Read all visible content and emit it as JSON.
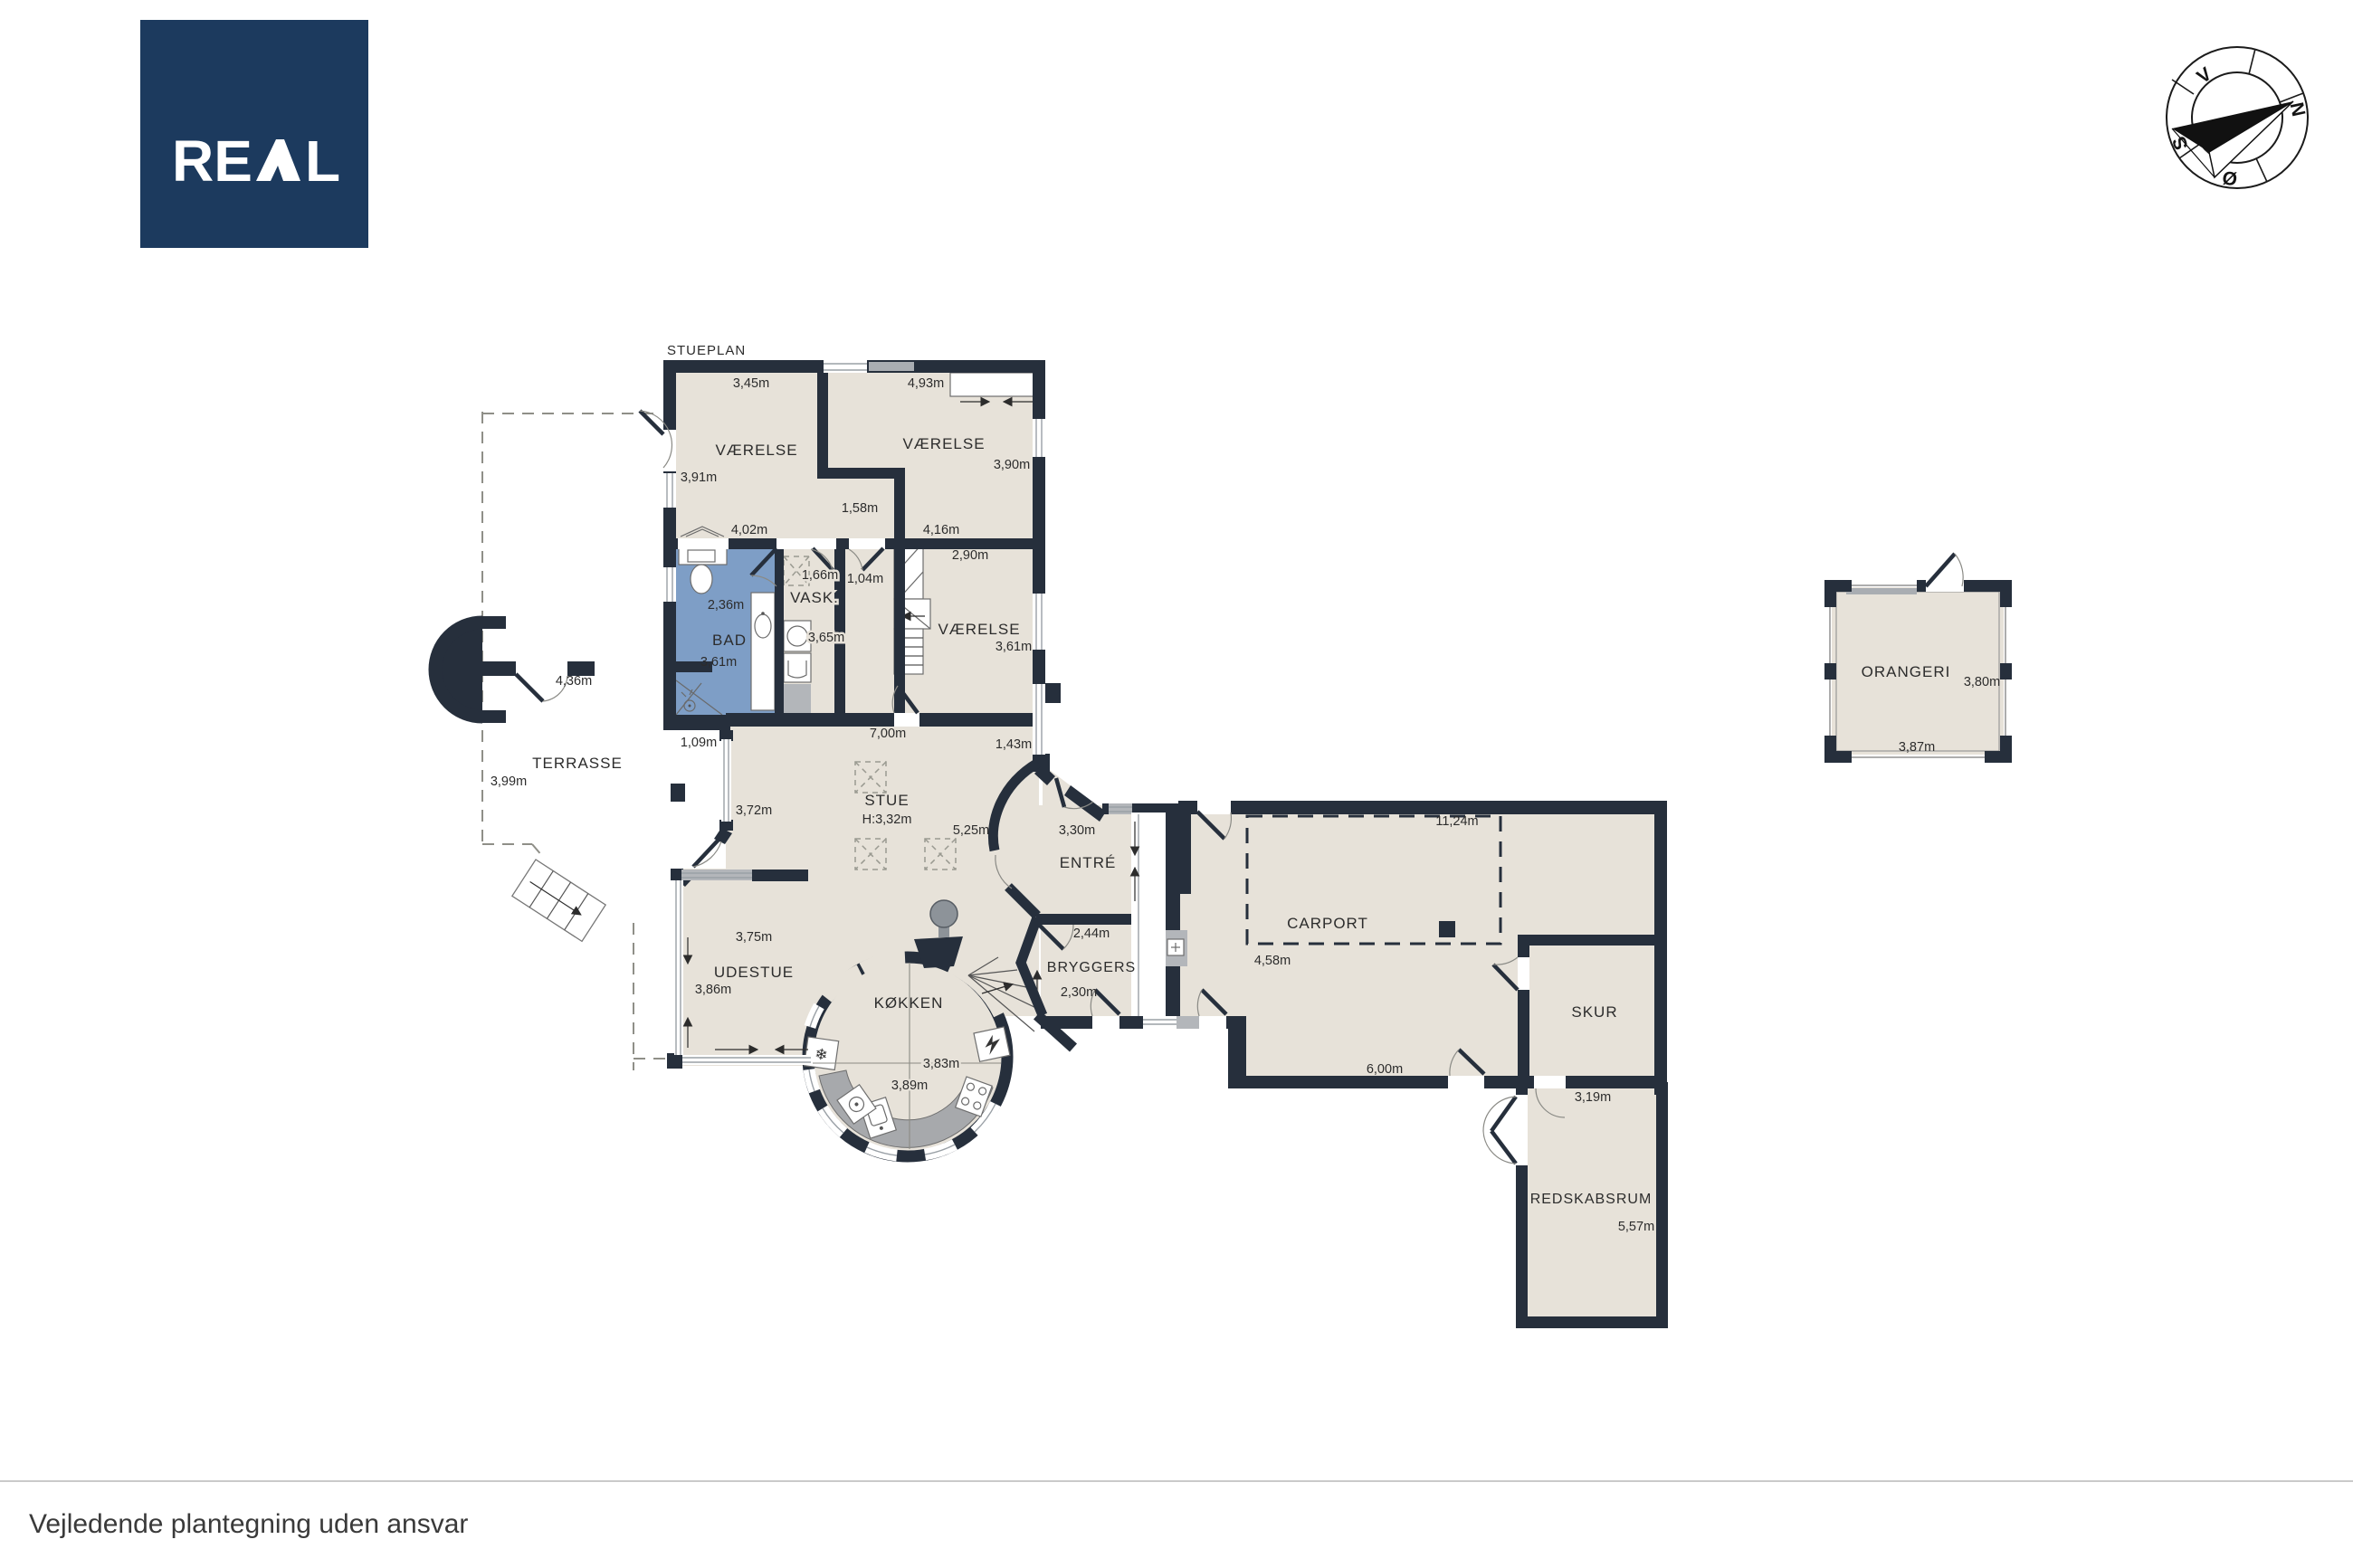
{
  "plan": {
    "title": "STUEPLAN"
  },
  "footer": {
    "disclaimer": "Vejledende plantegning uden ansvar"
  },
  "logo": {
    "text": "REAL",
    "part_re": "RE",
    "part_l": "L",
    "bg_color": "#1c3a5e"
  },
  "compass": {
    "north": "N",
    "south": "S",
    "east": "Ø",
    "west": "V"
  },
  "colors": {
    "wall": "#262f3c",
    "floor": "#e7e2d9",
    "bath": "#7e9ec6",
    "counter": "#a7a9ac"
  },
  "rooms": {
    "vaerelse_nw": {
      "label": "VÆRELSE",
      "width": "3,45m",
      "depth": "3,91m",
      "wall": "4,02m"
    },
    "vaerelse_ne": {
      "label": "VÆRELSE",
      "width": "4,93m",
      "depth": "3,90m"
    },
    "corridor": {
      "width": "1,58m",
      "door_a": "1,66m",
      "door_b": "1,04m"
    },
    "bad": {
      "label": "BAD",
      "width": "2,36m",
      "depth": "3,61m"
    },
    "vask": {
      "label": "VASK.",
      "depth": "3,65m"
    },
    "vaerelse_mid": {
      "label": "VÆRELSE",
      "width": "2,90m",
      "depth": "3,61m",
      "wall": "4,16m"
    },
    "stue": {
      "label": "STUE",
      "ceiling": "H:3,32m",
      "width": "7,00m",
      "depth": "5,25m",
      "side": "3,72m",
      "niche": "1,09m",
      "window": "1,43m"
    },
    "entre": {
      "label": "ENTRÉ",
      "width": "3,30m"
    },
    "bryggers": {
      "label": "BRYGGERS",
      "width": "2,44m",
      "depth": "2,30m"
    },
    "udestue": {
      "label": "UDESTUE",
      "width": "3,75m",
      "depth": "3,86m"
    },
    "kokken": {
      "label": "KØKKEN",
      "width": "3,83m",
      "depth": "3,89m"
    },
    "terrasse": {
      "label": "TERRASSE",
      "depth": "3,99m",
      "gap": "4,36m"
    },
    "carport": {
      "label": "CARPORT",
      "width": "4,58m",
      "length": "11,24m",
      "south": "6,00m"
    },
    "skur": {
      "label": "SKUR"
    },
    "redskabsrum": {
      "label": "REDSKABSRUM",
      "width": "3,19m",
      "depth": "5,57m"
    },
    "orangeri": {
      "label": "ORANGERI",
      "width": "3,87m",
      "depth": "3,80m"
    }
  }
}
